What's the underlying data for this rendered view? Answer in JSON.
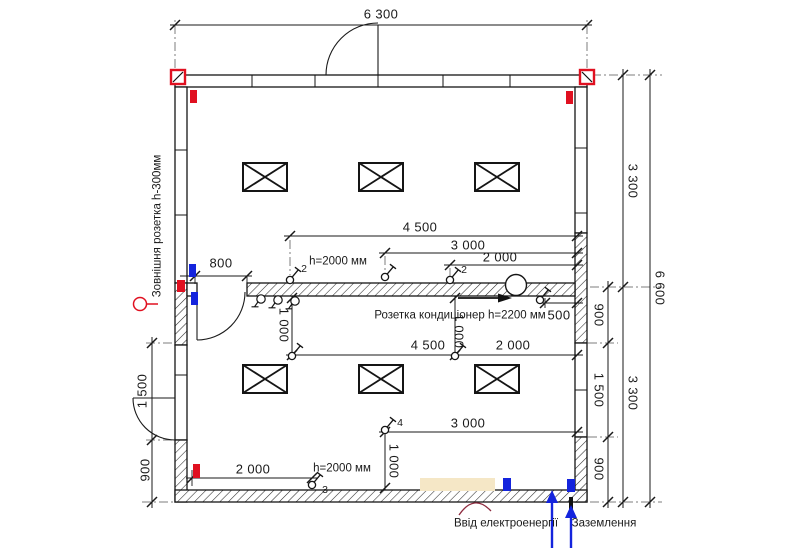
{
  "plan": {
    "dimensions": {
      "overall_width": "6 300",
      "overall_height": "6 600",
      "right_upper_3300": "3 300",
      "right_lower_3300": "3 300",
      "right_900_top": "900",
      "right_1500": "1 500",
      "right_900_bottom": "900",
      "left_1500": "1 500",
      "left_900": "900",
      "door_800": "800",
      "top_4500": "4 500",
      "top_3000": "3 000",
      "top_2000": "2 000",
      "switch_height_top": "h=2000 мм",
      "mid_1000_left": "1 000",
      "mid_1000_right": "1 000",
      "mid_4500": "4 500",
      "mid_2000": "2 000",
      "ac_500": "500",
      "low_3000": "3 000",
      "low_1000": "1 000",
      "low_2000": "2 000",
      "switch_height_bottom": "h=2000 мм"
    },
    "annotations": {
      "external_socket": "Зовнішня розетка h-300мм",
      "ac_socket": "Розетка кондиціонер h=2200 мм",
      "power_input": "Ввід електроенергії",
      "grounding": "Заземлення"
    },
    "circuits": {
      "switch_2a": "2",
      "switch_2b": "2",
      "switch_3": "3",
      "switch_4": "4"
    },
    "colors": {
      "line": "#1a1a1a",
      "socket_red": "#e01020",
      "socket_blue": "#1424dd",
      "panel_beige": "#f5e7c6",
      "extension_gray": "#7d7d7d"
    }
  }
}
